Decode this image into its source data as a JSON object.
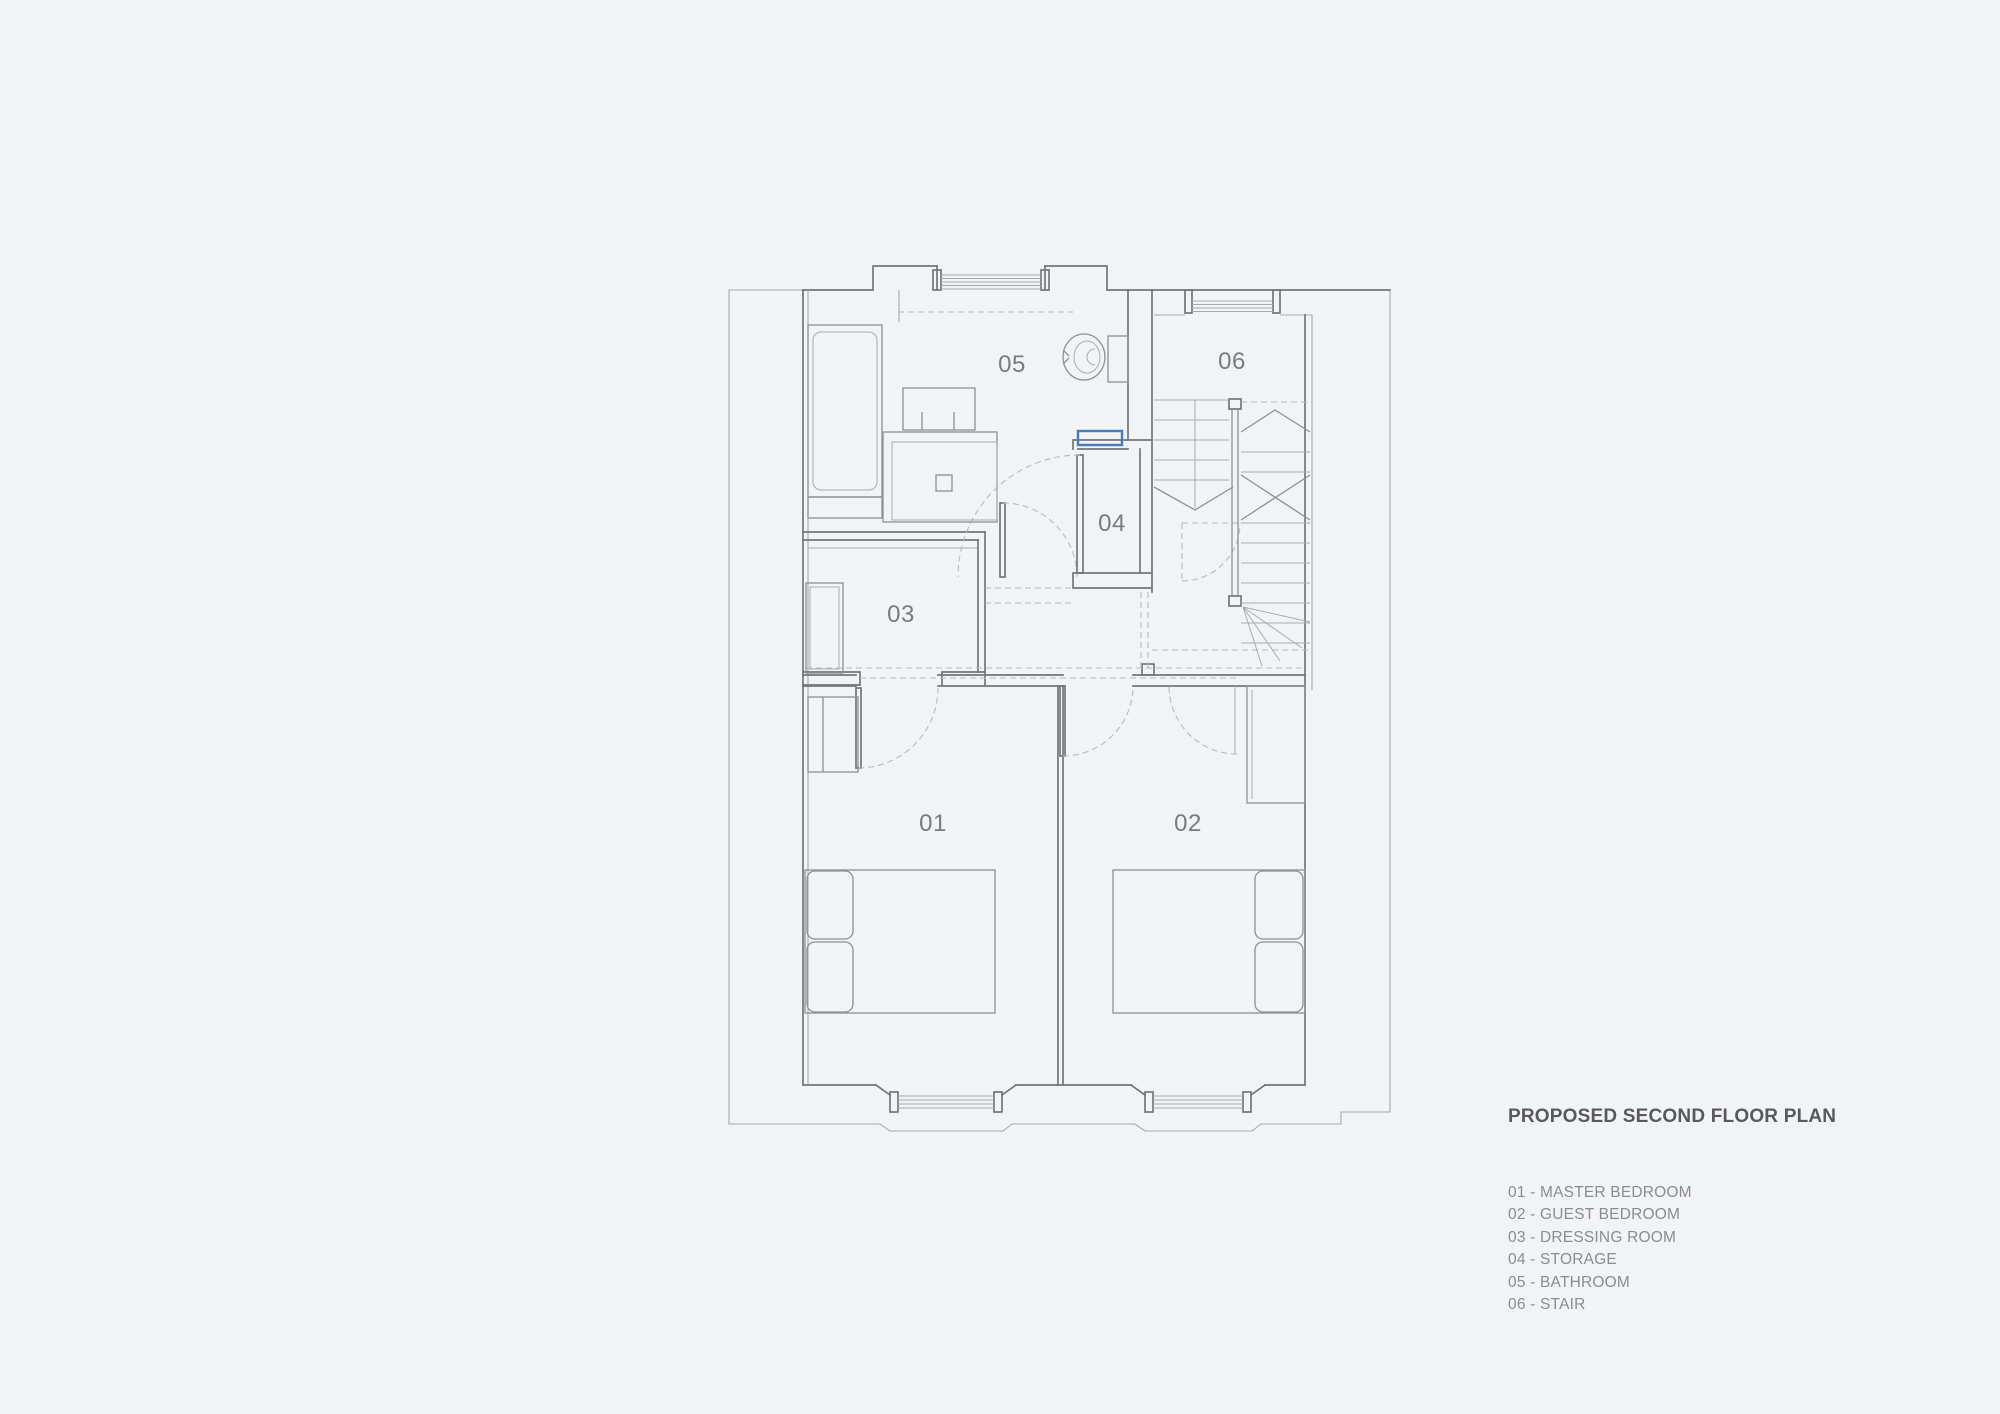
{
  "drawing": {
    "title": "PROPOSED SECOND FLOOR PLAN",
    "legend_items": [
      {
        "code": "01",
        "name": "MASTER BEDROOM",
        "text": "01 - MASTER BEDROOM"
      },
      {
        "code": "02",
        "name": "GUEST BEDROOM",
        "text": "02 - GUEST BEDROOM"
      },
      {
        "code": "03",
        "name": "DRESSING ROOM",
        "text": "03 - DRESSING ROOM"
      },
      {
        "code": "04",
        "name": "STORAGE",
        "text": "04 - STORAGE"
      },
      {
        "code": "05",
        "name": "BATHROOM",
        "text": "05 - BATHROOM"
      },
      {
        "code": "06",
        "name": "STAIR",
        "text": "06 - STAIR"
      }
    ],
    "room_labels": {
      "r01": "01",
      "r02": "02",
      "r03": "03",
      "r04": "04",
      "r05": "05",
      "r06": "06"
    },
    "colors": {
      "background": "#f2f3f5",
      "wall_line": "#747679",
      "light_line": "#a6a8ab",
      "fixture_line": "#8e9093",
      "dashed_line": "#b8babc",
      "accent_blue": "#4a7ab9",
      "title_text": "#58595b",
      "legend_text": "#8a8c8e",
      "room_label_text": "#797b7e"
    }
  }
}
